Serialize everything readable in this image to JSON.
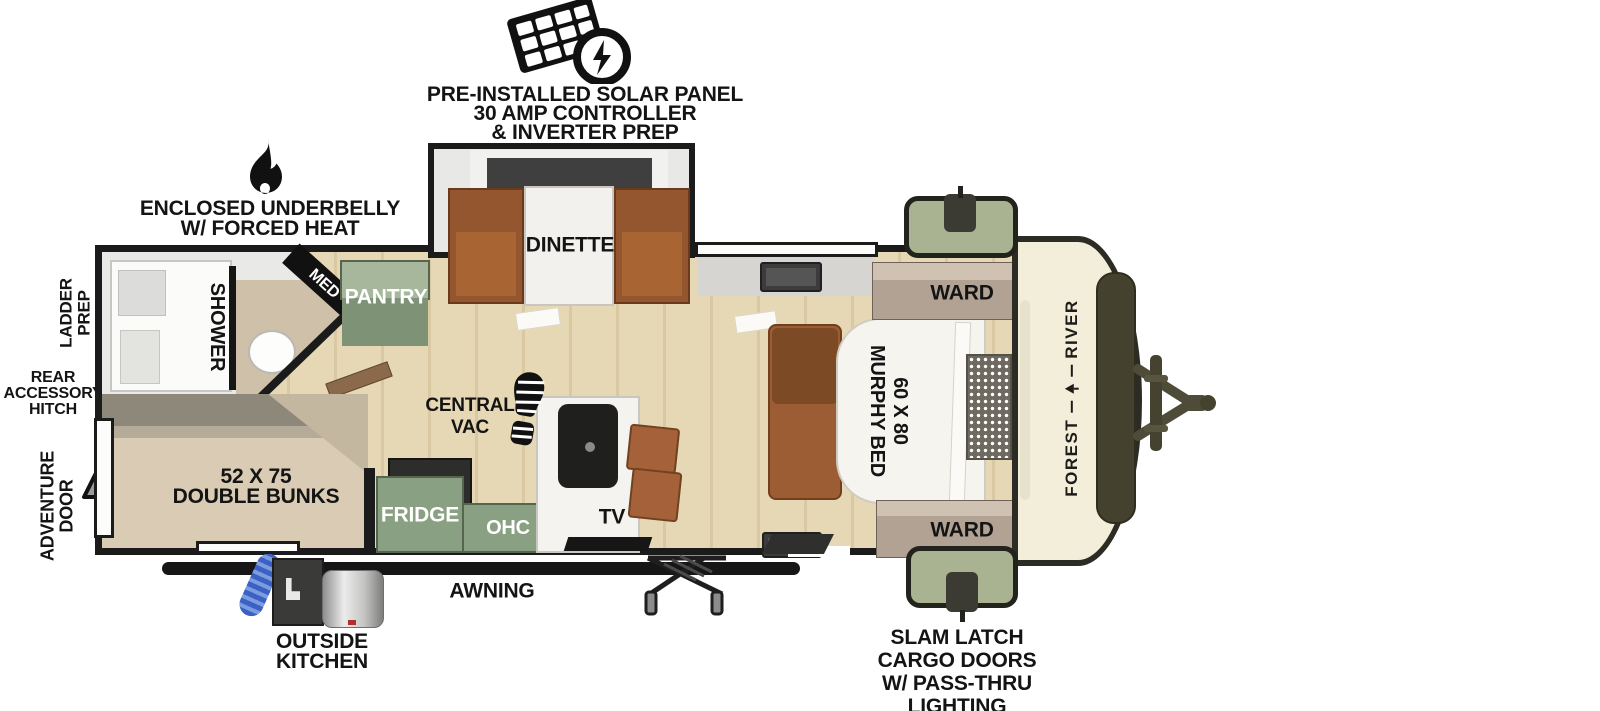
{
  "features": {
    "solar": {
      "line1": "PRE-INSTALLED SOLAR PANEL",
      "line2": "30 AMP CONTROLLER",
      "line3": "& INVERTER PREP"
    },
    "underbelly": {
      "line1": "ENCLOSED UNDERBELLY",
      "line2": "W/ FORCED HEAT"
    },
    "ladder_prep": {
      "line1": "LADDER",
      "line2": "PREP"
    },
    "rear_accessory_hitch": {
      "line1": "REAR",
      "line2": "ACCESSORY",
      "line3": "HITCH"
    },
    "adventure_door": {
      "line1": "ADVENTURE",
      "line2": "DOOR"
    },
    "awning": {
      "label": "AWNING"
    },
    "outside_kitchen": {
      "line1": "OUTSIDE",
      "line2": "KITCHEN"
    },
    "slam_latch": {
      "line1": "SLAM LATCH",
      "line2": "CARGO DOORS",
      "line3": "W/ PASS-THRU",
      "line4": "LIGHTING"
    }
  },
  "rooms": {
    "dinette": "DINETTE",
    "pantry": "PANTRY",
    "med": "MED",
    "shower": "SHOWER",
    "central_vac": {
      "line1": "CENTRAL",
      "line2": "VAC"
    },
    "double_bunks": {
      "line1": "52 X 75",
      "line2": "DOUBLE BUNKS"
    },
    "fridge": "FRIDGE",
    "ohc": "OHC",
    "tv": "TV",
    "murphy_bed": {
      "line1": "60 X 80",
      "line2": "MURPHY BED"
    },
    "ward_top": "WARD",
    "ward_bottom": "WARD"
  },
  "brand": {
    "forest": "FOREST",
    "river": "RIVER"
  },
  "colors": {
    "wall_black": "#1B1B1B",
    "wood_floor": "#E6D8B4",
    "sage_green": "#A9B291",
    "cabinet_green": "#8AA083",
    "cabinet_brown": "#9C5C34",
    "ward_tan": "#B2A294",
    "front_cap_cream": "#F2EEDA",
    "hitch_olive": "#4E4C38"
  }
}
